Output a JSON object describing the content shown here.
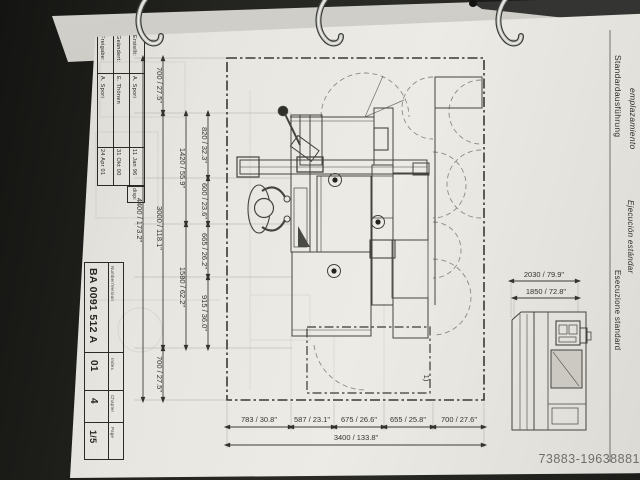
{
  "photo": {
    "watermark": "73883-19638881"
  },
  "header": {
    "title_es": "emplazamiento",
    "title_de": "Standardausführung",
    "subtitle_es": "Ejecución estándar",
    "subtitle_it": "Esecuzione standard"
  },
  "revision_table": {
    "cols": [
      {
        "label": "Freigabe:",
        "name": "A. Spori",
        "date": "24 Apr 01"
      },
      {
        "label": "Geändert:",
        "name": "E. Thönen",
        "date": "31 Okt 00"
      },
      {
        "label": "Erstellt:",
        "name": "A. Spori",
        "date": "11 Jan 96"
      }
    ],
    "note": "dispi"
  },
  "title_block": {
    "number_label": "Number/Version",
    "number": "BA 0091 512 A",
    "index_label": "Index",
    "index": "01",
    "chapter_label": "Chapter",
    "chapter": "4",
    "page_label": "Page",
    "page": "1/5"
  },
  "drawing": {
    "dims": {
      "total_w": "4400 / 173.2\"",
      "w700a": "700 / 27.5\"",
      "w3000": "3000 / 118.1\"",
      "w700b": "700 / 27.5\"",
      "w1420": "1420 / 55.9\"",
      "w1580": "1580 / 62.2\"",
      "w820": "820 / 32.3\"",
      "w600": "600 / 23.6\"",
      "w665": "665 / 26.2\"",
      "w915": "915 / 36.0\"",
      "d783": "783 / 30.8\"",
      "d587": "587 / 23.1\"",
      "d675": "675 / 26.6\"",
      "d655": "655 / 25.8\"",
      "d700": "700 / 27.6\"",
      "total_d": "3400 / 133.8\"",
      "e2030": "2030 / 79.9\"",
      "e1850": "1850 / 72.8\"",
      "note": "1)"
    }
  }
}
